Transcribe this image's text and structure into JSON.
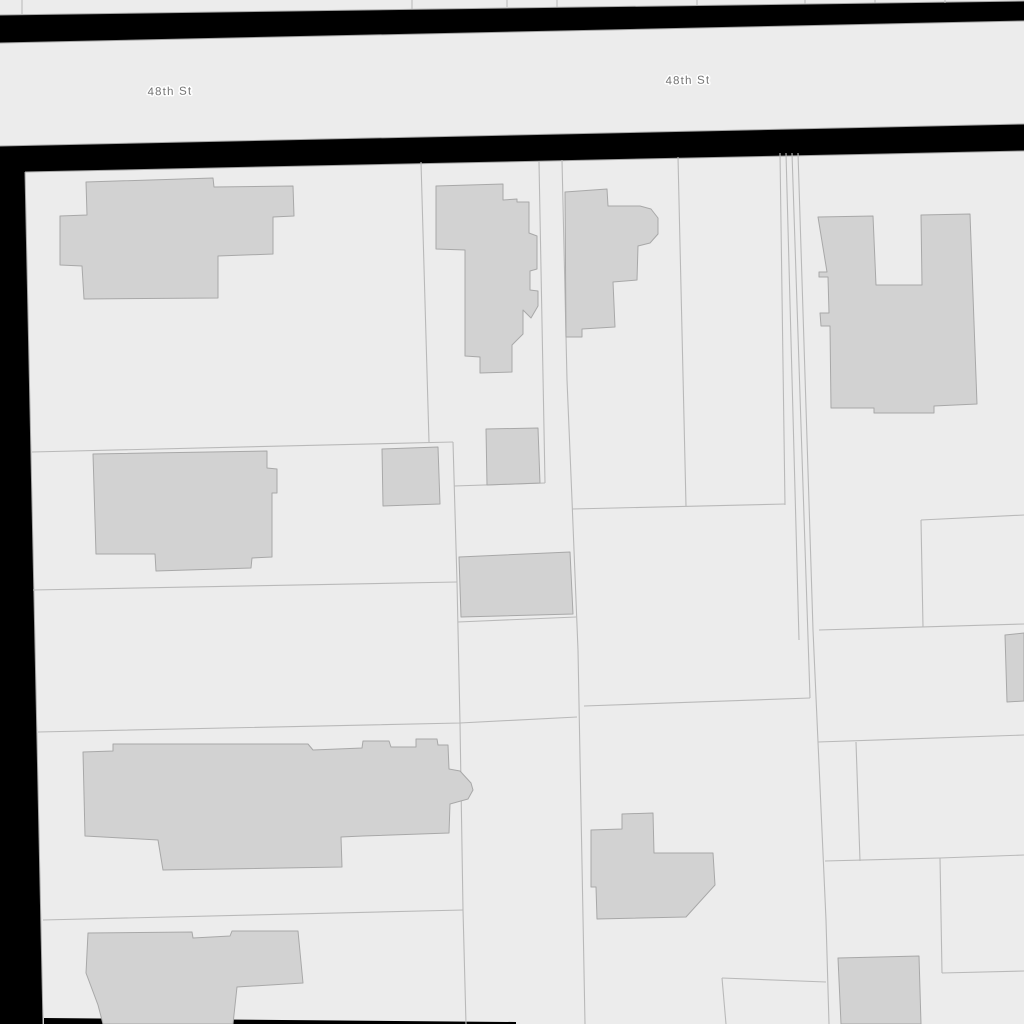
{
  "app": {
    "description": "GIS parcel map viewport showing 48th St, parcel boundaries and building footprints"
  },
  "colors": {
    "background": "#000000",
    "land_fill": "#ececec",
    "street_fill": "#ececec",
    "building_fill": "#d2d2d2",
    "building_stroke": "#a8a8a8",
    "parcel_line": "#b9b9b9",
    "edge_line": "#a5a5a5",
    "label_color": "#737373",
    "label_halo": "#ffffff"
  },
  "street": {
    "name": "48th St",
    "labels": [
      {
        "text": "48th St",
        "x": 170,
        "y": 95,
        "rotate": -1.2
      },
      {
        "text": "48th St",
        "x": 688,
        "y": 84,
        "rotate": -1.2
      }
    ]
  },
  "map": {
    "areas": [
      {
        "id": "north-block-strip",
        "fill": "land_fill",
        "points": [
          [
            0,
            0
          ],
          [
            1024,
            0
          ],
          [
            1024,
            1
          ],
          [
            0,
            15
          ]
        ]
      },
      {
        "id": "street-48th",
        "fill": "street_fill",
        "points": [
          [
            0,
            43
          ],
          [
            1024,
            21
          ],
          [
            1024,
            124
          ],
          [
            0,
            146
          ]
        ]
      },
      {
        "id": "south-block",
        "fill": "land_fill",
        "points": [
          [
            25,
            172
          ],
          [
            1024,
            151
          ],
          [
            1024,
            1024
          ],
          [
            43,
            1024
          ]
        ]
      },
      {
        "id": "bottom-street-casing",
        "fill": "background",
        "points": [
          [
            44,
            1018
          ],
          [
            516,
            1022
          ],
          [
            516,
            1024
          ],
          [
            44,
            1024
          ]
        ]
      }
    ],
    "edge_lines": [
      {
        "id": "north-strip-bottom-edge",
        "points": [
          [
            0,
            15
          ],
          [
            1024,
            1
          ]
        ]
      },
      {
        "id": "street-top-edge",
        "points": [
          [
            0,
            43
          ],
          [
            1024,
            21
          ]
        ]
      },
      {
        "id": "street-bottom-edge",
        "points": [
          [
            0,
            146
          ],
          [
            1024,
            124
          ]
        ]
      },
      {
        "id": "block-top-edge",
        "points": [
          [
            25,
            172
          ],
          [
            1024,
            151
          ]
        ]
      },
      {
        "id": "block-left-edge",
        "points": [
          [
            25,
            172
          ],
          [
            43,
            1024
          ]
        ]
      }
    ],
    "north_strip_lines": [
      [
        [
          22,
          0
        ],
        [
          22,
          14
        ]
      ],
      [
        [
          412,
          0
        ],
        [
          412,
          9
        ]
      ],
      [
        [
          507,
          0
        ],
        [
          507,
          7
        ]
      ],
      [
        [
          557,
          0
        ],
        [
          557,
          7
        ]
      ],
      [
        [
          697,
          0
        ],
        [
          697,
          5
        ]
      ],
      [
        [
          805,
          0
        ],
        [
          805,
          4
        ]
      ],
      [
        [
          875,
          0
        ],
        [
          875,
          3
        ]
      ],
      [
        [
          945,
          0
        ],
        [
          945,
          3
        ]
      ]
    ],
    "parcel_lines": [
      [
        [
          32,
          452
        ],
        [
          453,
          442
        ]
      ],
      [
        [
          421,
          162
        ],
        [
          429,
          442
        ]
      ],
      [
        [
          453,
          442
        ],
        [
          457,
          582
        ],
        [
          460,
          723
        ],
        [
          463,
          910
        ],
        [
          466,
          1024
        ]
      ],
      [
        [
          539,
          162
        ],
        [
          545,
          483
        ]
      ],
      [
        [
          545,
          483
        ],
        [
          454,
          486
        ]
      ],
      [
        [
          562,
          160
        ],
        [
          567,
          380
        ],
        [
          572,
          500
        ],
        [
          578,
          650
        ],
        [
          585,
          1024
        ]
      ],
      [
        [
          678,
          157
        ],
        [
          686,
          506
        ]
      ],
      [
        [
          780,
          153
        ],
        [
          785,
          505
        ]
      ],
      [
        [
          786,
          153
        ],
        [
          799,
          640
        ]
      ],
      [
        [
          792,
          153
        ],
        [
          810,
          698
        ]
      ],
      [
        [
          798,
          153
        ],
        [
          813,
          630
        ],
        [
          818,
          742
        ],
        [
          826,
          920
        ],
        [
          829,
          1024
        ]
      ],
      [
        [
          33,
          590
        ],
        [
          457,
          582
        ]
      ],
      [
        [
          458,
          622
        ],
        [
          576,
          617
        ]
      ],
      [
        [
          38,
          732
        ],
        [
          460,
          723
        ],
        [
          577,
          717
        ]
      ],
      [
        [
          584,
          706
        ],
        [
          810,
          698
        ]
      ],
      [
        [
          572,
          509
        ],
        [
          785,
          504
        ]
      ],
      [
        [
          819,
          630
        ],
        [
          1024,
          624
        ]
      ],
      [
        [
          921,
          520
        ],
        [
          1024,
          515
        ]
      ],
      [
        [
          921,
          520
        ],
        [
          923,
          627
        ]
      ],
      [
        [
          43,
          920
        ],
        [
          463,
          910
        ]
      ],
      [
        [
          818,
          742
        ],
        [
          1024,
          735
        ]
      ],
      [
        [
          825,
          861
        ],
        [
          940,
          858
        ],
        [
          1024,
          855
        ]
      ],
      [
        [
          940,
          858
        ],
        [
          942,
          973
        ]
      ],
      [
        [
          942,
          973
        ],
        [
          1024,
          971
        ]
      ],
      [
        [
          722,
          978
        ],
        [
          826,
          982
        ]
      ],
      [
        [
          722,
          978
        ],
        [
          726,
          1024
        ]
      ],
      [
        [
          856,
          742
        ],
        [
          860,
          861
        ]
      ]
    ],
    "buildings": [
      {
        "id": "building-1",
        "points": [
          [
            86,
            182
          ],
          [
            213,
            178
          ],
          [
            214,
            187
          ],
          [
            293,
            186
          ],
          [
            294,
            216
          ],
          [
            273,
            217
          ],
          [
            273,
            254
          ],
          [
            218,
            256
          ],
          [
            218,
            298
          ],
          [
            84,
            299
          ],
          [
            82,
            266
          ],
          [
            60,
            265
          ],
          [
            60,
            216
          ],
          [
            87,
            215
          ]
        ]
      },
      {
        "id": "building-2",
        "points": [
          [
            436,
            186
          ],
          [
            503,
            184
          ],
          [
            503,
            200
          ],
          [
            517,
            199
          ],
          [
            517,
            202
          ],
          [
            529,
            202
          ],
          [
            529,
            233
          ],
          [
            537,
            236
          ],
          [
            537,
            269
          ],
          [
            530,
            271
          ],
          [
            530,
            290
          ],
          [
            538,
            291
          ],
          [
            538,
            306
          ],
          [
            531,
            318
          ],
          [
            523,
            310
          ],
          [
            523,
            334
          ],
          [
            512,
            345
          ],
          [
            512,
            372
          ],
          [
            480,
            373
          ],
          [
            480,
            357
          ],
          [
            465,
            356
          ],
          [
            465,
            250
          ],
          [
            436,
            249
          ]
        ]
      },
      {
        "id": "building-3",
        "points": [
          [
            565,
            192
          ],
          [
            607,
            189
          ],
          [
            608,
            206
          ],
          [
            640,
            206
          ],
          [
            651,
            209
          ],
          [
            658,
            218
          ],
          [
            658,
            234
          ],
          [
            650,
            243
          ],
          [
            638,
            246
          ],
          [
            637,
            280
          ],
          [
            613,
            282
          ],
          [
            615,
            327
          ],
          [
            582,
            329
          ],
          [
            582,
            337
          ],
          [
            566,
            337
          ]
        ]
      },
      {
        "id": "building-4",
        "points": [
          [
            818,
            217
          ],
          [
            873,
            216
          ],
          [
            876,
            285
          ],
          [
            922,
            285
          ],
          [
            921,
            215
          ],
          [
            970,
            214
          ],
          [
            977,
            404
          ],
          [
            934,
            406
          ],
          [
            934,
            413
          ],
          [
            874,
            413
          ],
          [
            874,
            408
          ],
          [
            831,
            408
          ],
          [
            830,
            326
          ],
          [
            821,
            326
          ],
          [
            820,
            313
          ],
          [
            829,
            313
          ],
          [
            828,
            277
          ],
          [
            819,
            277
          ],
          [
            819,
            272
          ],
          [
            827,
            272
          ]
        ]
      },
      {
        "id": "building-5",
        "points": [
          [
            93,
            454
          ],
          [
            267,
            451
          ],
          [
            267,
            468
          ],
          [
            277,
            469
          ],
          [
            277,
            493
          ],
          [
            272,
            493
          ],
          [
            272,
            557
          ],
          [
            252,
            558
          ],
          [
            251,
            568
          ],
          [
            156,
            571
          ],
          [
            155,
            554
          ],
          [
            96,
            554
          ]
        ]
      },
      {
        "id": "building-6",
        "points": [
          [
            382,
            449
          ],
          [
            438,
            447
          ],
          [
            440,
            504
          ],
          [
            383,
            506
          ]
        ]
      },
      {
        "id": "building-7",
        "points": [
          [
            486,
            429
          ],
          [
            538,
            428
          ],
          [
            540,
            483
          ],
          [
            487,
            485
          ]
        ]
      },
      {
        "id": "building-8",
        "points": [
          [
            459,
            557
          ],
          [
            570,
            552
          ],
          [
            573,
            614
          ],
          [
            461,
            617
          ]
        ]
      },
      {
        "id": "building-9",
        "points": [
          [
            83,
            752
          ],
          [
            113,
            751
          ],
          [
            113,
            744
          ],
          [
            308,
            744
          ],
          [
            313,
            750
          ],
          [
            362,
            748
          ],
          [
            363,
            741
          ],
          [
            389,
            741
          ],
          [
            391,
            747
          ],
          [
            416,
            747
          ],
          [
            416,
            739
          ],
          [
            437,
            739
          ],
          [
            438,
            745
          ],
          [
            448,
            745
          ],
          [
            449,
            769
          ],
          [
            460,
            771
          ],
          [
            471,
            783
          ],
          [
            473,
            790
          ],
          [
            468,
            799
          ],
          [
            450,
            804
          ],
          [
            449,
            833
          ],
          [
            363,
            836
          ],
          [
            341,
            837
          ],
          [
            342,
            867
          ],
          [
            163,
            870
          ],
          [
            158,
            840
          ],
          [
            85,
            836
          ]
        ]
      },
      {
        "id": "building-10",
        "points": [
          [
            88,
            933
          ],
          [
            192,
            932
          ],
          [
            193,
            938
          ],
          [
            230,
            936
          ],
          [
            232,
            931
          ],
          [
            298,
            931
          ],
          [
            303,
            983
          ],
          [
            237,
            987
          ],
          [
            233,
            1024
          ],
          [
            103,
            1024
          ],
          [
            98,
            1005
          ],
          [
            86,
            973
          ]
        ]
      },
      {
        "id": "building-11",
        "points": [
          [
            838,
            958
          ],
          [
            919,
            956
          ],
          [
            921,
            1024
          ],
          [
            841,
            1024
          ]
        ]
      },
      {
        "id": "building-12",
        "points": [
          [
            1005,
            635
          ],
          [
            1024,
            633
          ],
          [
            1024,
            701
          ],
          [
            1007,
            702
          ]
        ]
      },
      {
        "id": "building-13",
        "points": [
          [
            591,
            830
          ],
          [
            622,
            829
          ],
          [
            622,
            814
          ],
          [
            653,
            813
          ],
          [
            654,
            853
          ],
          [
            713,
            853
          ],
          [
            715,
            885
          ],
          [
            686,
            917
          ],
          [
            597,
            919
          ],
          [
            596,
            887
          ],
          [
            591,
            887
          ]
        ]
      }
    ]
  }
}
